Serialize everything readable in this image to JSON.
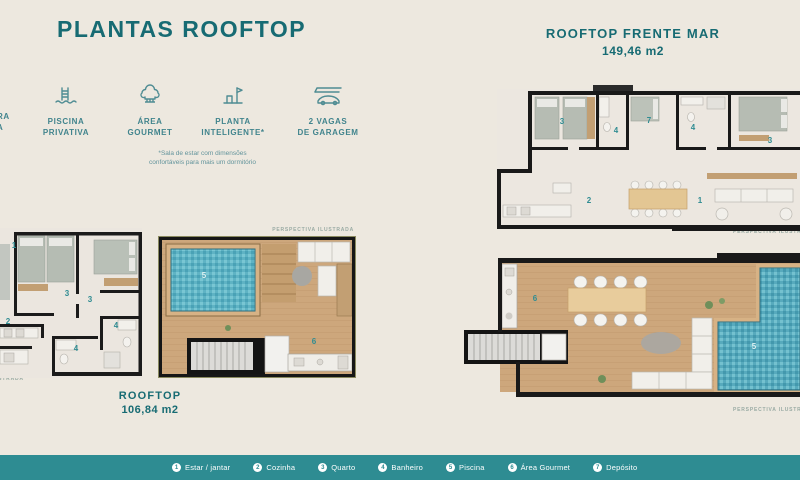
{
  "page": {
    "title": "PLANTAS ROOFTOP",
    "perspectiva_label": "PERSPECTIVA ILUSTRADA",
    "colors": {
      "background": "#EDE8DF",
      "teal_dark": "#176B73",
      "teal": "#2E8C92",
      "icon_teal": "#4F8C93",
      "wall": "#191919",
      "wood": "#CDA77C",
      "pool": "#5FB3C4"
    }
  },
  "amenities": {
    "cutoff": {
      "line1": "RA",
      "line2": "A"
    },
    "items": [
      {
        "icon": "pool-ladder-icon",
        "label1": "PISCINA",
        "label2": "PRIVATIVA"
      },
      {
        "icon": "chef-hat-icon",
        "label1": "ÁREA",
        "label2": "GOURMET"
      },
      {
        "icon": "smart-plan-icon",
        "label1": "PLANTA",
        "label2": "INTELIGENTE*"
      },
      {
        "icon": "car-garage-icon",
        "label1": "2 VAGAS",
        "label2": "DE GARAGEM"
      }
    ],
    "footnote_line1": "*Sala de estar com dimensões",
    "footnote_line2": "confortáveis para mais um dormitório"
  },
  "units": {
    "left": {
      "name": "ROOFTOP",
      "area": "106,84 m2"
    },
    "right": {
      "name": "ROOFTOP FRENTE MAR",
      "area": "149,46 m2"
    }
  },
  "rooms": {
    "estar": "1",
    "cozinha": "2",
    "quarto": "3",
    "banheiro": "4",
    "piscina": "5",
    "gourmet": "6",
    "deposito": "7"
  },
  "legend": {
    "items": [
      {
        "n": "1",
        "label": "Estar / jantar"
      },
      {
        "n": "2",
        "label": "Cozinha"
      },
      {
        "n": "3",
        "label": "Quarto"
      },
      {
        "n": "4",
        "label": "Banheiro"
      },
      {
        "n": "5",
        "label": "Piscina"
      },
      {
        "n": "6",
        "label": "Área Gourmet"
      },
      {
        "n": "7",
        "label": "Depósito"
      }
    ]
  }
}
